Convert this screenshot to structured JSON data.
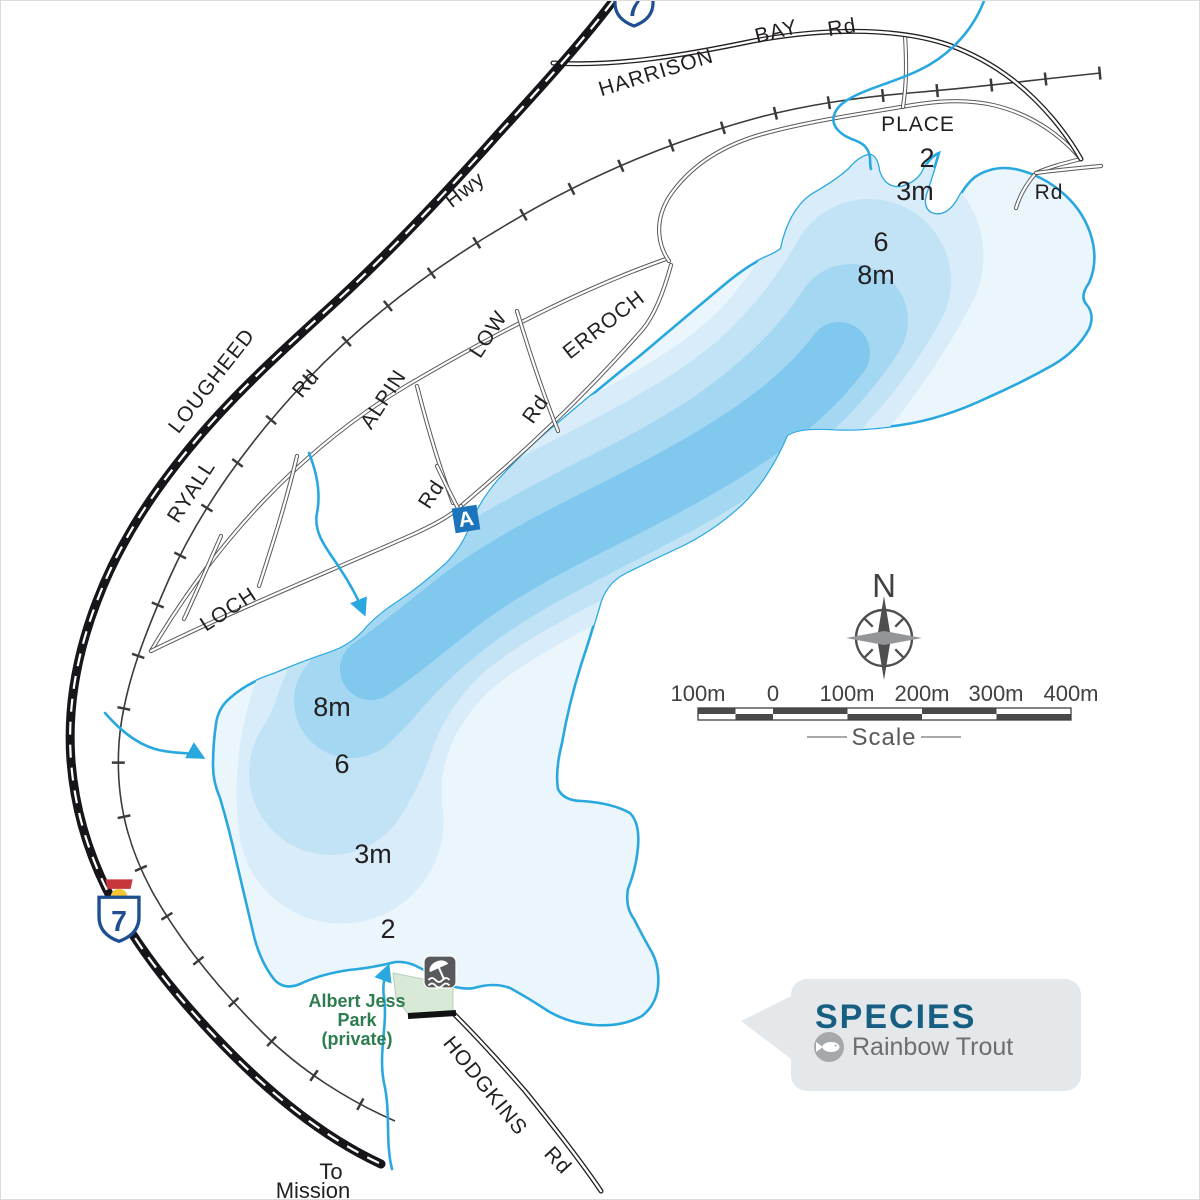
{
  "map_labels": {
    "lougheed": "LOUGHEED",
    "lougheed_suffix": "Hwy",
    "harrison": "HARRISON",
    "bay": "BAY",
    "harrison_rd": "Rd",
    "place": "PLACE",
    "place_rd": "Rd",
    "ryall": "RYALL",
    "ryall_rd": "Rd",
    "alpin": "ALPIN",
    "low": "LOW",
    "low_rd": "Rd",
    "erroch": "ERROCH",
    "loch": "LOCH",
    "access_rd": "Rd",
    "hodgkins": "HODGKINS",
    "hodgkins_rd": "Rd",
    "to_line1": "To",
    "to_line2": "Mission"
  },
  "depth_labels": {
    "ne": {
      "d2": "2",
      "d3": "3m",
      "d6": "6",
      "d8": "8m"
    },
    "sw": {
      "d8": "8m",
      "d6": "6",
      "d3": "3m",
      "d2": "2"
    }
  },
  "park": {
    "line1": "Albert Jess",
    "line2": "Park",
    "line3": "(private)"
  },
  "markers": {
    "access": "A"
  },
  "highway_shields": {
    "top": "7",
    "west": "7"
  },
  "compass": {
    "label": "N"
  },
  "scale_bar": {
    "labels": [
      "100m",
      "0",
      "100m",
      "200m",
      "300m",
      "400m"
    ],
    "caption": "Scale"
  },
  "species_panel": {
    "title": "SPECIES",
    "items": [
      {
        "icon": "fish-icon",
        "name": "Rainbow Trout"
      }
    ]
  },
  "colors": {
    "water_outline": "#29a8e0",
    "water_shallow": "#eaf5fc",
    "water_2m": "#d8ecf9",
    "water_3m": "#c2e3f6",
    "water_6m": "#a4d7f2",
    "water_8m": "#80c8ee",
    "park_fill": "#d8e9d8",
    "park_text": "#2e7d4e",
    "species_accent": "#175f82",
    "species_box": "#e4e8ea",
    "shield_blue": "#1d4f91"
  }
}
